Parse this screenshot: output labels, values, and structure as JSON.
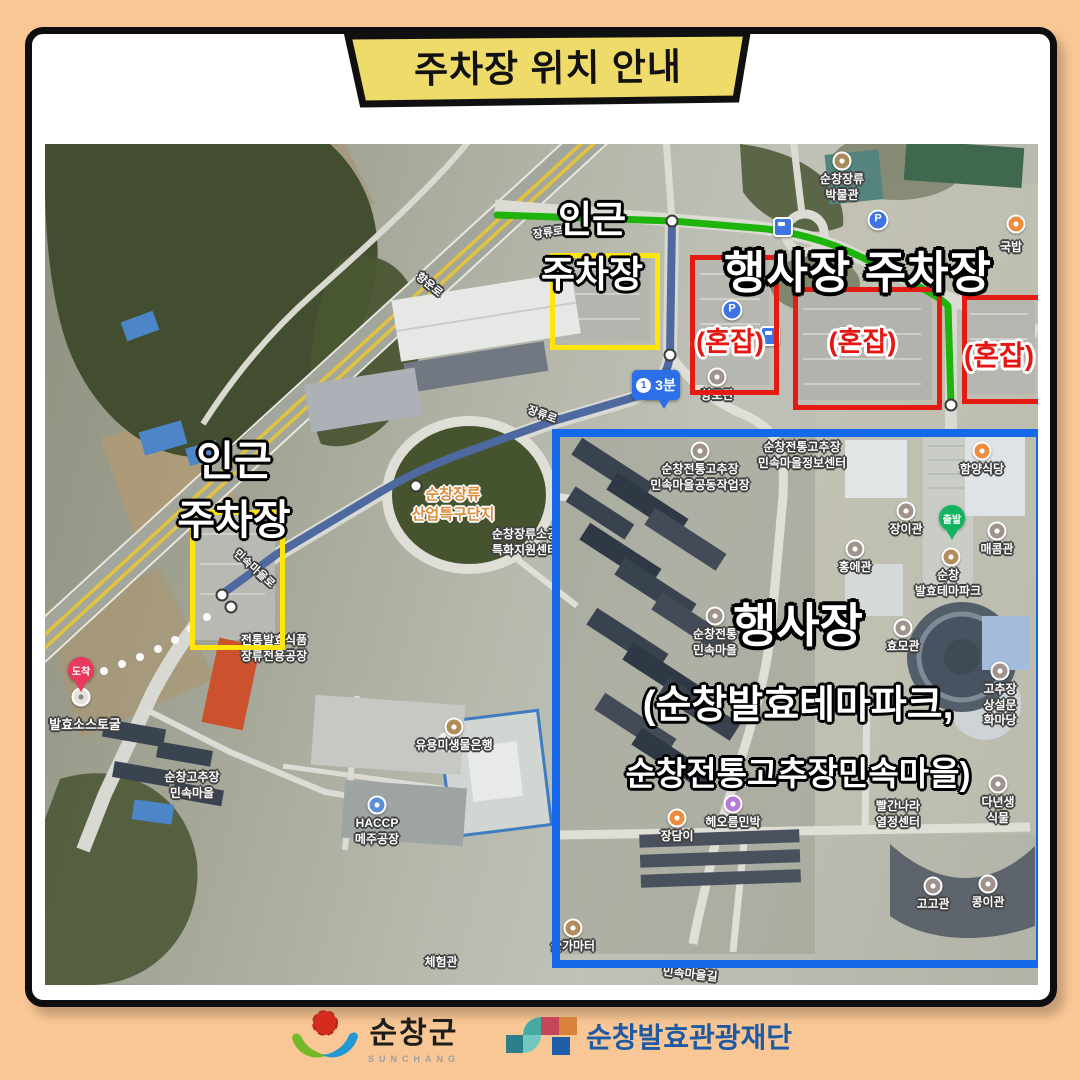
{
  "poster": {
    "title": "주차장 위치 안내",
    "colors": {
      "background": "#f9c795",
      "banner_fill": "#eedb69",
      "nearby_box": "#ffe508",
      "congested_box": "#e31b12",
      "venue_box": "#1568ea",
      "route_green": "#1eb40c",
      "route_blue": "#4e699f",
      "badge_blue": "#2d6fe8"
    }
  },
  "map": {
    "labels": {
      "nearby_top": [
        "인근",
        "주차장"
      ],
      "nearby_left": [
        "인근",
        "주차장"
      ],
      "event_parking_title": "행사장 주차장",
      "congested": "(혼잡)",
      "venue_title": "행사장",
      "venue_sub1": "(순창발효테마파크,",
      "venue_sub2": "순창전통고추장민속마을)",
      "route_step": "1",
      "route_time": "3분",
      "depart": "출발",
      "arrive": "도착"
    },
    "icons": {
      "parking_glyph": "P"
    },
    "pois": [
      {
        "t": "순창장류\n박물관",
        "x": 797,
        "y": 28,
        "m": "museum"
      },
      {
        "t": "국밥",
        "x": 966,
        "y": 96,
        "m": "orange",
        "mx": 971,
        "my": 80
      },
      {
        "t": "향토관",
        "x": 672,
        "y": 244,
        "m": "gray"
      },
      {
        "t": "순창전통고추장\n민속마을정보센터",
        "x": 757,
        "y": 296
      },
      {
        "t": "순창전통고추장\n민속마을공동작업장",
        "x": 655,
        "y": 318,
        "m": "gray"
      },
      {
        "t": "함양식당",
        "x": 937,
        "y": 318,
        "m": "orange"
      },
      {
        "t": "장이관",
        "x": 861,
        "y": 378,
        "m": "gray"
      },
      {
        "t": "매콤관",
        "x": 952,
        "y": 398,
        "m": "gray"
      },
      {
        "t": "순창\n발효테마파크",
        "x": 903,
        "y": 424
      },
      {
        "t": "홍에관",
        "x": 810,
        "y": 416,
        "m": "gray"
      },
      {
        "t": "효모관",
        "x": 858,
        "y": 495,
        "m": "gray"
      },
      {
        "t": "고추장\n상설문화마당",
        "x": 955,
        "y": 538,
        "m": "gray"
      },
      {
        "t": "순창전통\n민속마을",
        "x": 670,
        "y": 483,
        "m": "gray"
      },
      {
        "t": "빨간나라\n열정센터",
        "x": 853,
        "y": 655
      },
      {
        "t": "다년생식물",
        "x": 953,
        "y": 651,
        "m": "gray"
      },
      {
        "t": "고고관",
        "x": 888,
        "y": 753,
        "m": "gray"
      },
      {
        "t": "콩이관",
        "x": 943,
        "y": 751,
        "m": "gray"
      },
      {
        "t": "장담이",
        "x": 632,
        "y": 685,
        "m": "orange"
      },
      {
        "t": "헤오름민박",
        "x": 688,
        "y": 671,
        "m": "purple"
      },
      {
        "t": "숯가마터",
        "x": 528,
        "y": 795,
        "m": "tan"
      },
      {
        "t": "체험관",
        "x": 396,
        "y": 811
      },
      {
        "t": "민속마을길",
        "x": 645,
        "y": 823,
        "rot": 6
      },
      {
        "t": "순창고추장\n민속마을",
        "x": 147,
        "y": 626
      },
      {
        "t": "발효소스토굴",
        "x": 40,
        "y": 573,
        "fs": 13
      },
      {
        "t": "전통발효식품\n장류전용공장",
        "x": 229,
        "y": 489
      },
      {
        "t": "HACCP\n메주공장",
        "x": 332,
        "y": 672,
        "m": "blue"
      },
      {
        "t": "유용미생물은행",
        "x": 409,
        "y": 594,
        "m": "tan"
      },
      {
        "t": "순창장류\n산업특구단지",
        "x": 408,
        "y": 341,
        "c": "orange",
        "fs": 15
      },
      {
        "t": "순창장류소공\n특화지원센터",
        "x": 480,
        "y": 383
      },
      {
        "t": "장류로",
        "x": 503,
        "y": 82,
        "rot": -8,
        "fs": 11
      },
      {
        "t": "장류로",
        "x": 497,
        "y": 264,
        "rot": 20,
        "fs": 11
      },
      {
        "t": "민속마을로",
        "x": 209,
        "y": 418,
        "rot": 42,
        "fs": 11
      },
      {
        "t": "향운로",
        "x": 384,
        "y": 134,
        "rot": 40,
        "fs": 11
      },
      {
        "t": "",
        "m": "parking",
        "x": 833,
        "y": 76
      },
      {
        "t": "",
        "m": "parking",
        "x": 687,
        "y": 166
      },
      {
        "t": "",
        "m": "bus",
        "x": 738,
        "y": 83
      },
      {
        "t": "",
        "m": "bus",
        "x": 725,
        "y": 192
      },
      {
        "t": "",
        "m": "tan",
        "x": 906,
        "y": 413
      },
      {
        "t": "",
        "m": "white",
        "x": 36,
        "y": 553
      }
    ]
  },
  "footer": {
    "sunchang": {
      "name": "순창군",
      "latin": "SUNCHANG"
    },
    "foundation": {
      "name": "순창발효관광재단"
    }
  }
}
